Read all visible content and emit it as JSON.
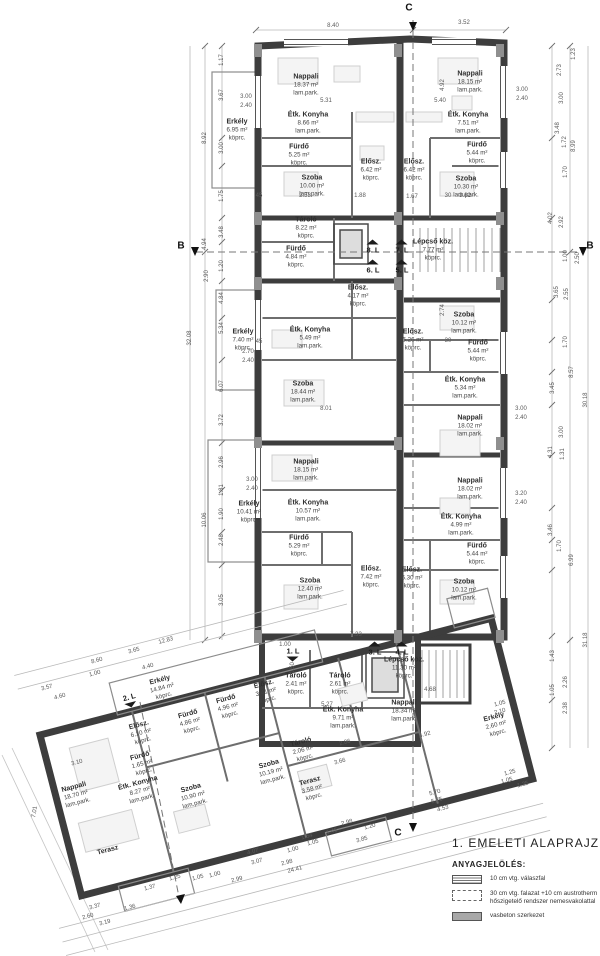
{
  "drawing": {
    "title": "1. EMELETI ALAPRAJZ m=1:100",
    "legend": {
      "heading": "ANYAGJELÖLÉS:",
      "items": [
        {
          "swatch": "partition-stripes",
          "label": "10 cm vtg. válaszfal"
        },
        {
          "swatch": "masonry-dotted",
          "label": "30 cm vtg. falazat +10 cm austrotherm hőszigetelő rendszer nemesvakolattal"
        },
        {
          "swatch": "concrete-gray",
          "label": "vasbeton szerkezet"
        }
      ]
    },
    "colors": {
      "wall": "#3d3d3d",
      "concrete": "#8f8f8f",
      "dimline": "#b0b0b0",
      "text": "#2e2e2e"
    }
  },
  "sections": [
    {
      "t": "B",
      "x": 181,
      "y": 246
    },
    {
      "t": "B",
      "x": 590,
      "y": 246
    },
    {
      "t": "C",
      "x": 409,
      "y": 8
    },
    {
      "t": "C",
      "x": 398,
      "y": 833
    }
  ],
  "units": [
    {
      "t": "8. L",
      "x": 373,
      "y": 247,
      "w": "up"
    },
    {
      "t": "7. L",
      "x": 402,
      "y": 247,
      "w": "up"
    },
    {
      "t": "6. L",
      "x": 373,
      "y": 267,
      "w": "up"
    },
    {
      "t": "5. L",
      "x": 402,
      "y": 267,
      "w": "up"
    },
    {
      "t": "3. L",
      "x": 375,
      "y": 649,
      "w": "up"
    },
    {
      "t": "4. L",
      "x": 402,
      "y": 649,
      "w": "up"
    },
    {
      "t": "1. L",
      "x": 293,
      "y": 654,
      "w": "down"
    },
    {
      "t": "2. L",
      "x": 130,
      "y": 700,
      "w": "down",
      "r": -15
    }
  ],
  "rooms": [
    {
      "name": "Nappali",
      "area": "18.37 m²",
      "fin": "lam.park.",
      "x": 306,
      "y": 85
    },
    {
      "name": "Erkély",
      "area": "6.95 m²",
      "fin": "köprc.",
      "x": 237,
      "y": 130
    },
    {
      "name": "Étk. Konyha",
      "area": "8.66 m²",
      "fin": "lam.park.",
      "x": 308,
      "y": 123
    },
    {
      "name": "Fürdő",
      "area": "5.25 m²",
      "fin": "köprc.",
      "x": 299,
      "y": 155
    },
    {
      "name": "Szoba",
      "area": "10.00 m²",
      "fin": "lam.park.",
      "x": 312,
      "y": 186
    },
    {
      "name": "Elősz.",
      "area": "6.42 m²",
      "fin": "köprc.",
      "x": 371,
      "y": 170
    },
    {
      "name": "Elősz.",
      "area": "6.42 m²",
      "fin": "köprc.",
      "x": 414,
      "y": 170
    },
    {
      "name": "Nappali",
      "area": "18.15 m²",
      "fin": "lam.park.",
      "x": 470,
      "y": 82
    },
    {
      "name": "Étk. Konyha",
      "area": "7.51 m²",
      "fin": "lam.park.",
      "x": 468,
      "y": 123
    },
    {
      "name": "Fürdő",
      "area": "5.44 m²",
      "fin": "köprc.",
      "x": 477,
      "y": 153
    },
    {
      "name": "Szoba",
      "area": "10.30 m²",
      "fin": "lam.park.",
      "x": 466,
      "y": 187
    },
    {
      "name": "Tároló",
      "area": "8.22 m²",
      "fin": "köprc.",
      "x": 306,
      "y": 228
    },
    {
      "name": "Lépcső köz.",
      "area": "7.77 m²",
      "fin": "köprc.",
      "x": 433,
      "y": 250
    },
    {
      "name": "Fürdő",
      "area": "4.84 m²",
      "fin": "köprc.",
      "x": 296,
      "y": 257
    },
    {
      "name": "Elősz.",
      "area": "4.17 m²",
      "fin": "köprc.",
      "x": 358,
      "y": 296
    },
    {
      "name": "Erkély",
      "area": "7.40 m²",
      "fin": "köprc.",
      "x": 243,
      "y": 340
    },
    {
      "name": "Étk. Konyha",
      "area": "5.49 m²",
      "fin": "lam.park.",
      "x": 310,
      "y": 338
    },
    {
      "name": "Szoba",
      "area": "18.44 m²",
      "fin": "lam.park.",
      "x": 303,
      "y": 392
    },
    {
      "name": "Elősz.",
      "area": "6.26 m²",
      "fin": "köprc.",
      "x": 413,
      "y": 340
    },
    {
      "name": "Szoba",
      "area": "10.12 m²",
      "fin": "lam.park.",
      "x": 464,
      "y": 323
    },
    {
      "name": "Fürdő",
      "area": "5.44 m²",
      "fin": "köprc.",
      "x": 478,
      "y": 351
    },
    {
      "name": "Étk. Konyha",
      "area": "5.34 m²",
      "fin": "lam.park.",
      "x": 465,
      "y": 388
    },
    {
      "name": "Nappali",
      "area": "18.02 m²",
      "fin": "lam.park.",
      "x": 470,
      "y": 426
    },
    {
      "name": "Nappali",
      "area": "18.15 m²",
      "fin": "lam.park.",
      "x": 306,
      "y": 470
    },
    {
      "name": "Erkély",
      "area": "10.41 m²",
      "fin": "köprc.",
      "x": 249,
      "y": 512
    },
    {
      "name": "Étk. Konyha",
      "area": "10.57 m²",
      "fin": "lam.park.",
      "x": 308,
      "y": 511
    },
    {
      "name": "Fürdő",
      "area": "5.29 m²",
      "fin": "köprc.",
      "x": 299,
      "y": 546
    },
    {
      "name": "Szoba",
      "area": "12.40 m²",
      "fin": "lam.park.",
      "x": 310,
      "y": 589
    },
    {
      "name": "Elősz.",
      "area": "7.42 m²",
      "fin": "köprc.",
      "x": 371,
      "y": 577
    },
    {
      "name": "Nappali",
      "area": "18.02 m²",
      "fin": "lam.park.",
      "x": 470,
      "y": 489
    },
    {
      "name": "Étk. Konyha",
      "area": "4.99 m²",
      "fin": "lam.park.",
      "x": 461,
      "y": 525
    },
    {
      "name": "Fürdő",
      "area": "5.44 m²",
      "fin": "köprc.",
      "x": 477,
      "y": 554
    },
    {
      "name": "Szoba",
      "area": "10.12 m²",
      "fin": "lam.park.",
      "x": 464,
      "y": 590
    },
    {
      "name": "Elősz.",
      "area": "6.30 m²",
      "fin": "köprc.",
      "x": 412,
      "y": 578
    },
    {
      "name": "Lépcső köz.",
      "area": "11.30 m²",
      "fin": "köprc.",
      "x": 404,
      "y": 668
    },
    {
      "name": "Tároló",
      "area": "2.41 m²",
      "fin": "köprc.",
      "x": 296,
      "y": 684
    },
    {
      "name": "Tároló",
      "area": "2.61 m²",
      "fin": "köprc.",
      "x": 340,
      "y": 684
    },
    {
      "name": "Elősz.",
      "area": "3.41 m²",
      "fin": "köprc.",
      "x": 266,
      "y": 692,
      "r": -15
    },
    {
      "name": "Étk. Konyha",
      "area": "9.71 m²",
      "fin": "lam.park.",
      "x": 343,
      "y": 718
    },
    {
      "name": "Nappali",
      "area": "18.34 m²",
      "fin": "lam.park.",
      "x": 404,
      "y": 711
    },
    {
      "name": "Erkély",
      "area": "2.60 m²",
      "fin": "köprc.",
      "x": 496,
      "y": 725,
      "r": -15
    },
    {
      "name": "Erkély",
      "area": "14.84 m²",
      "fin": "köprc.",
      "x": 162,
      "y": 688,
      "r": -15
    },
    {
      "name": "Fürdő",
      "area": "4.96 m²",
      "fin": "köprc.",
      "x": 228,
      "y": 707,
      "r": -15
    },
    {
      "name": "Fürdő",
      "area": "4.86 m²",
      "fin": "köprc.",
      "x": 190,
      "y": 722,
      "r": -15
    },
    {
      "name": "Elősz.",
      "area": "6.10 m²",
      "fin": "köprc.",
      "x": 141,
      "y": 733,
      "r": -15
    },
    {
      "name": "Fürdő",
      "area": "1.65 m²",
      "fin": "köprc.",
      "x": 142,
      "y": 764,
      "r": -15
    },
    {
      "name": "Étk. Konyha",
      "area": "8.27 m²",
      "fin": "lam.park.",
      "x": 140,
      "y": 791,
      "r": -15
    },
    {
      "name": "Szoba",
      "area": "10.90 m²",
      "fin": "lam.park.",
      "x": 193,
      "y": 796,
      "r": -15
    },
    {
      "name": "Nappali",
      "area": "18.70 m²",
      "fin": "lam.park.",
      "x": 76,
      "y": 795,
      "r": -15
    },
    {
      "name": "Tároló",
      "area": "2.06 m²",
      "fin": "köprc.",
      "x": 303,
      "y": 750,
      "r": -15
    },
    {
      "name": "Szoba",
      "area": "10.19 m²",
      "fin": "lam.park.",
      "x": 271,
      "y": 772,
      "r": -15
    },
    {
      "name": "Terasz",
      "area": "3.58 m²",
      "fin": "köprc.",
      "x": 312,
      "y": 789,
      "r": -15
    },
    {
      "name": "Terasz",
      "area": "",
      "fin": "",
      "x": 108,
      "y": 851,
      "r": -15
    }
  ],
  "dims": [
    {
      "t": "8.40",
      "x": 333,
      "y": 26
    },
    {
      "t": "3.52",
      "x": 464,
      "y": 23
    },
    {
      "t": "1.17",
      "x": 222,
      "y": 60,
      "r": -90
    },
    {
      "t": "3.67",
      "x": 222,
      "y": 95,
      "r": -90
    },
    {
      "t": "3.00",
      "x": 222,
      "y": 148,
      "r": -90
    },
    {
      "t": "1.75",
      "x": 222,
      "y": 196,
      "r": -90
    },
    {
      "t": "3.48",
      "x": 222,
      "y": 232,
      "r": -90
    },
    {
      "t": "1.20",
      "x": 222,
      "y": 266,
      "r": -90
    },
    {
      "t": "4.84",
      "x": 222,
      "y": 298,
      "r": -90
    },
    {
      "t": "5.34",
      "x": 222,
      "y": 328,
      "r": -90
    },
    {
      "t": "6.07",
      "x": 222,
      "y": 386,
      "r": -90
    },
    {
      "t": "3.72",
      "x": 222,
      "y": 420,
      "r": -90
    },
    {
      "t": "2.96",
      "x": 222,
      "y": 462,
      "r": -90
    },
    {
      "t": "1.81",
      "x": 222,
      "y": 490,
      "r": -90
    },
    {
      "t": "1.90",
      "x": 222,
      "y": 514,
      "r": -90
    },
    {
      "t": "2.48",
      "x": 222,
      "y": 540,
      "r": -90
    },
    {
      "t": "3.05",
      "x": 222,
      "y": 600,
      "r": -90
    },
    {
      "t": "8.92",
      "x": 205,
      "y": 138,
      "r": -90
    },
    {
      "t": "4.94",
      "x": 205,
      "y": 244,
      "r": -90
    },
    {
      "t": "2.90",
      "x": 207,
      "y": 276,
      "r": -90
    },
    {
      "t": "10.06",
      "x": 205,
      "y": 520,
      "r": -90
    },
    {
      "t": "32.08",
      "x": 190,
      "y": 338,
      "r": -90
    },
    {
      "t": "2.73",
      "x": 560,
      "y": 70,
      "r": -90
    },
    {
      "t": "1.23",
      "x": 574,
      "y": 54,
      "r": -90
    },
    {
      "t": "3.00",
      "x": 562,
      "y": 98,
      "r": -90
    },
    {
      "t": "3.48",
      "x": 558,
      "y": 128,
      "r": -90
    },
    {
      "t": "1.72",
      "x": 565,
      "y": 142,
      "r": -90
    },
    {
      "t": "8.99",
      "x": 574,
      "y": 146,
      "r": -90
    },
    {
      "t": "1.70",
      "x": 566,
      "y": 172,
      "r": -90
    },
    {
      "t": "4.02",
      "x": 551,
      "y": 218,
      "r": -90
    },
    {
      "t": "2.92",
      "x": 562,
      "y": 222,
      "r": -90
    },
    {
      "t": "2.50",
      "x": 578,
      "y": 258,
      "r": -90
    },
    {
      "t": "1.00",
      "x": 566,
      "y": 256,
      "r": -90
    },
    {
      "t": "3.65",
      "x": 557,
      "y": 292,
      "r": -90
    },
    {
      "t": "2.55",
      "x": 567,
      "y": 294,
      "r": -90
    },
    {
      "t": "1.70",
      "x": 566,
      "y": 342,
      "r": -90
    },
    {
      "t": "8.57",
      "x": 572,
      "y": 372,
      "r": -90
    },
    {
      "t": "30.18",
      "x": 586,
      "y": 400,
      "r": -90
    },
    {
      "t": "3.45",
      "x": 553,
      "y": 388,
      "r": -90
    },
    {
      "t": "4.31",
      "x": 551,
      "y": 452,
      "r": -90
    },
    {
      "t": "1.31",
      "x": 563,
      "y": 454,
      "r": -90
    },
    {
      "t": "3.00",
      "x": 562,
      "y": 432,
      "r": -90
    },
    {
      "t": "3.46",
      "x": 551,
      "y": 530,
      "r": -90
    },
    {
      "t": "1.70",
      "x": 560,
      "y": 546,
      "r": -90
    },
    {
      "t": "6.99",
      "x": 572,
      "y": 560,
      "r": -90
    },
    {
      "t": "1.43",
      "x": 553,
      "y": 656,
      "r": -90
    },
    {
      "t": "2.26",
      "x": 566,
      "y": 682,
      "r": -90
    },
    {
      "t": "2.38",
      "x": 566,
      "y": 708,
      "r": -90
    },
    {
      "t": "31.18",
      "x": 586,
      "y": 640,
      "r": -90
    },
    {
      "t": "1.05",
      "x": 553,
      "y": 690,
      "r": -90
    },
    {
      "t": "3.00",
      "x": 246,
      "y": 97
    },
    {
      "t": "2.40",
      "x": 246,
      "y": 106
    },
    {
      "t": "2.70",
      "x": 248,
      "y": 352
    },
    {
      "t": "2.40",
      "x": 248,
      "y": 361
    },
    {
      "t": "3.00",
      "x": 252,
      "y": 480
    },
    {
      "t": "2.40",
      "x": 252,
      "y": 489
    },
    {
      "t": "3.00",
      "x": 522,
      "y": 90
    },
    {
      "t": "2.40",
      "x": 522,
      "y": 99
    },
    {
      "t": "3.00",
      "x": 521,
      "y": 409
    },
    {
      "t": "2.40",
      "x": 521,
      "y": 418
    },
    {
      "t": "3.20",
      "x": 521,
      "y": 494
    },
    {
      "t": "2.40",
      "x": 521,
      "y": 503
    },
    {
      "t": "5.31",
      "x": 326,
      "y": 101
    },
    {
      "t": "5.40",
      "x": 440,
      "y": 101
    },
    {
      "t": "2.53",
      "x": 305,
      "y": 196
    },
    {
      "t": "1.88",
      "x": 360,
      "y": 196
    },
    {
      "t": "1.67",
      "x": 412,
      "y": 197
    },
    {
      "t": "3.62",
      "x": 465,
      "y": 196
    },
    {
      "t": "2.74",
      "x": 443,
      "y": 310,
      "r": -90
    },
    {
      "t": "8.01",
      "x": 326,
      "y": 409
    },
    {
      "t": "4.92",
      "x": 443,
      "y": 85,
      "r": -90
    },
    {
      "t": "45",
      "x": 259,
      "y": 196
    },
    {
      "t": "30",
      "x": 448,
      "y": 196
    },
    {
      "t": "45",
      "x": 259,
      "y": 342
    },
    {
      "t": "30",
      "x": 448,
      "y": 341
    },
    {
      "t": "7.33",
      "x": 356,
      "y": 635
    },
    {
      "t": "4.68",
      "x": 430,
      "y": 690
    },
    {
      "t": "5.27",
      "x": 327,
      "y": 705
    },
    {
      "t": "1.00",
      "x": 285,
      "y": 645
    },
    {
      "t": "1.50",
      "x": 293,
      "y": 668,
      "r": -90
    },
    {
      "t": "12.83",
      "x": 166,
      "y": 641,
      "r": -15
    },
    {
      "t": "8.60",
      "x": 97,
      "y": 661,
      "r": -15
    },
    {
      "t": "3.65",
      "x": 134,
      "y": 651,
      "r": -15
    },
    {
      "t": "4.40",
      "x": 148,
      "y": 667,
      "r": -15
    },
    {
      "t": "1.00",
      "x": 95,
      "y": 674,
      "r": -15
    },
    {
      "t": "3.57",
      "x": 47,
      "y": 688,
      "r": -15
    },
    {
      "t": "4.60",
      "x": 60,
      "y": 697,
      "r": -15
    },
    {
      "t": "3.10",
      "x": 77,
      "y": 763,
      "r": -15
    },
    {
      "t": "7.01",
      "x": 35,
      "y": 812,
      "r": -80
    },
    {
      "t": "3.37",
      "x": 95,
      "y": 907,
      "r": -15
    },
    {
      "t": "2.60",
      "x": 88,
      "y": 917,
      "r": -15
    },
    {
      "t": "3.19",
      "x": 105,
      "y": 923,
      "r": -15
    },
    {
      "t": "1.36",
      "x": 130,
      "y": 908,
      "r": -15
    },
    {
      "t": "1.37",
      "x": 150,
      "y": 888,
      "r": -15
    },
    {
      "t": "1.25",
      "x": 175,
      "y": 878,
      "r": -15
    },
    {
      "t": "1.05",
      "x": 198,
      "y": 878,
      "r": -15
    },
    {
      "t": "1.00",
      "x": 215,
      "y": 875,
      "r": -15
    },
    {
      "t": "2.99",
      "x": 237,
      "y": 880,
      "r": -15
    },
    {
      "t": "24.41",
      "x": 295,
      "y": 870,
      "r": -15
    },
    {
      "t": "4.07",
      "x": 253,
      "y": 852,
      "r": -15
    },
    {
      "t": "3.07",
      "x": 257,
      "y": 862,
      "r": -15
    },
    {
      "t": "2.98",
      "x": 287,
      "y": 863,
      "r": -15
    },
    {
      "t": "1.54",
      "x": 307,
      "y": 837,
      "r": -15
    },
    {
      "t": "1.00",
      "x": 293,
      "y": 850,
      "r": -15
    },
    {
      "t": "1.05",
      "x": 313,
      "y": 843,
      "r": -15
    },
    {
      "t": "1.45",
      "x": 332,
      "y": 832,
      "r": -15
    },
    {
      "t": "2.98",
      "x": 347,
      "y": 823,
      "r": -15
    },
    {
      "t": "1.20",
      "x": 370,
      "y": 827,
      "r": -15
    },
    {
      "t": "3.85",
      "x": 362,
      "y": 840,
      "r": -15
    },
    {
      "t": "2.86",
      "x": 345,
      "y": 743,
      "r": -15
    },
    {
      "t": "3.66",
      "x": 340,
      "y": 762,
      "r": -15
    },
    {
      "t": "5.70",
      "x": 435,
      "y": 793,
      "r": -15
    },
    {
      "t": "5.75",
      "x": 437,
      "y": 801,
      "r": -15
    },
    {
      "t": "4.53",
      "x": 443,
      "y": 809,
      "r": -15
    },
    {
      "t": "1.25",
      "x": 510,
      "y": 773,
      "r": -15
    },
    {
      "t": "1.05",
      "x": 507,
      "y": 781,
      "r": -15
    },
    {
      "t": "1.25",
      "x": 523,
      "y": 785,
      "r": -15
    },
    {
      "t": "1.05",
      "x": 500,
      "y": 704,
      "r": -15
    },
    {
      "t": "2.10",
      "x": 500,
      "y": 712,
      "r": -15
    },
    {
      "t": "4.92",
      "x": 425,
      "y": 735,
      "r": -15
    }
  ]
}
